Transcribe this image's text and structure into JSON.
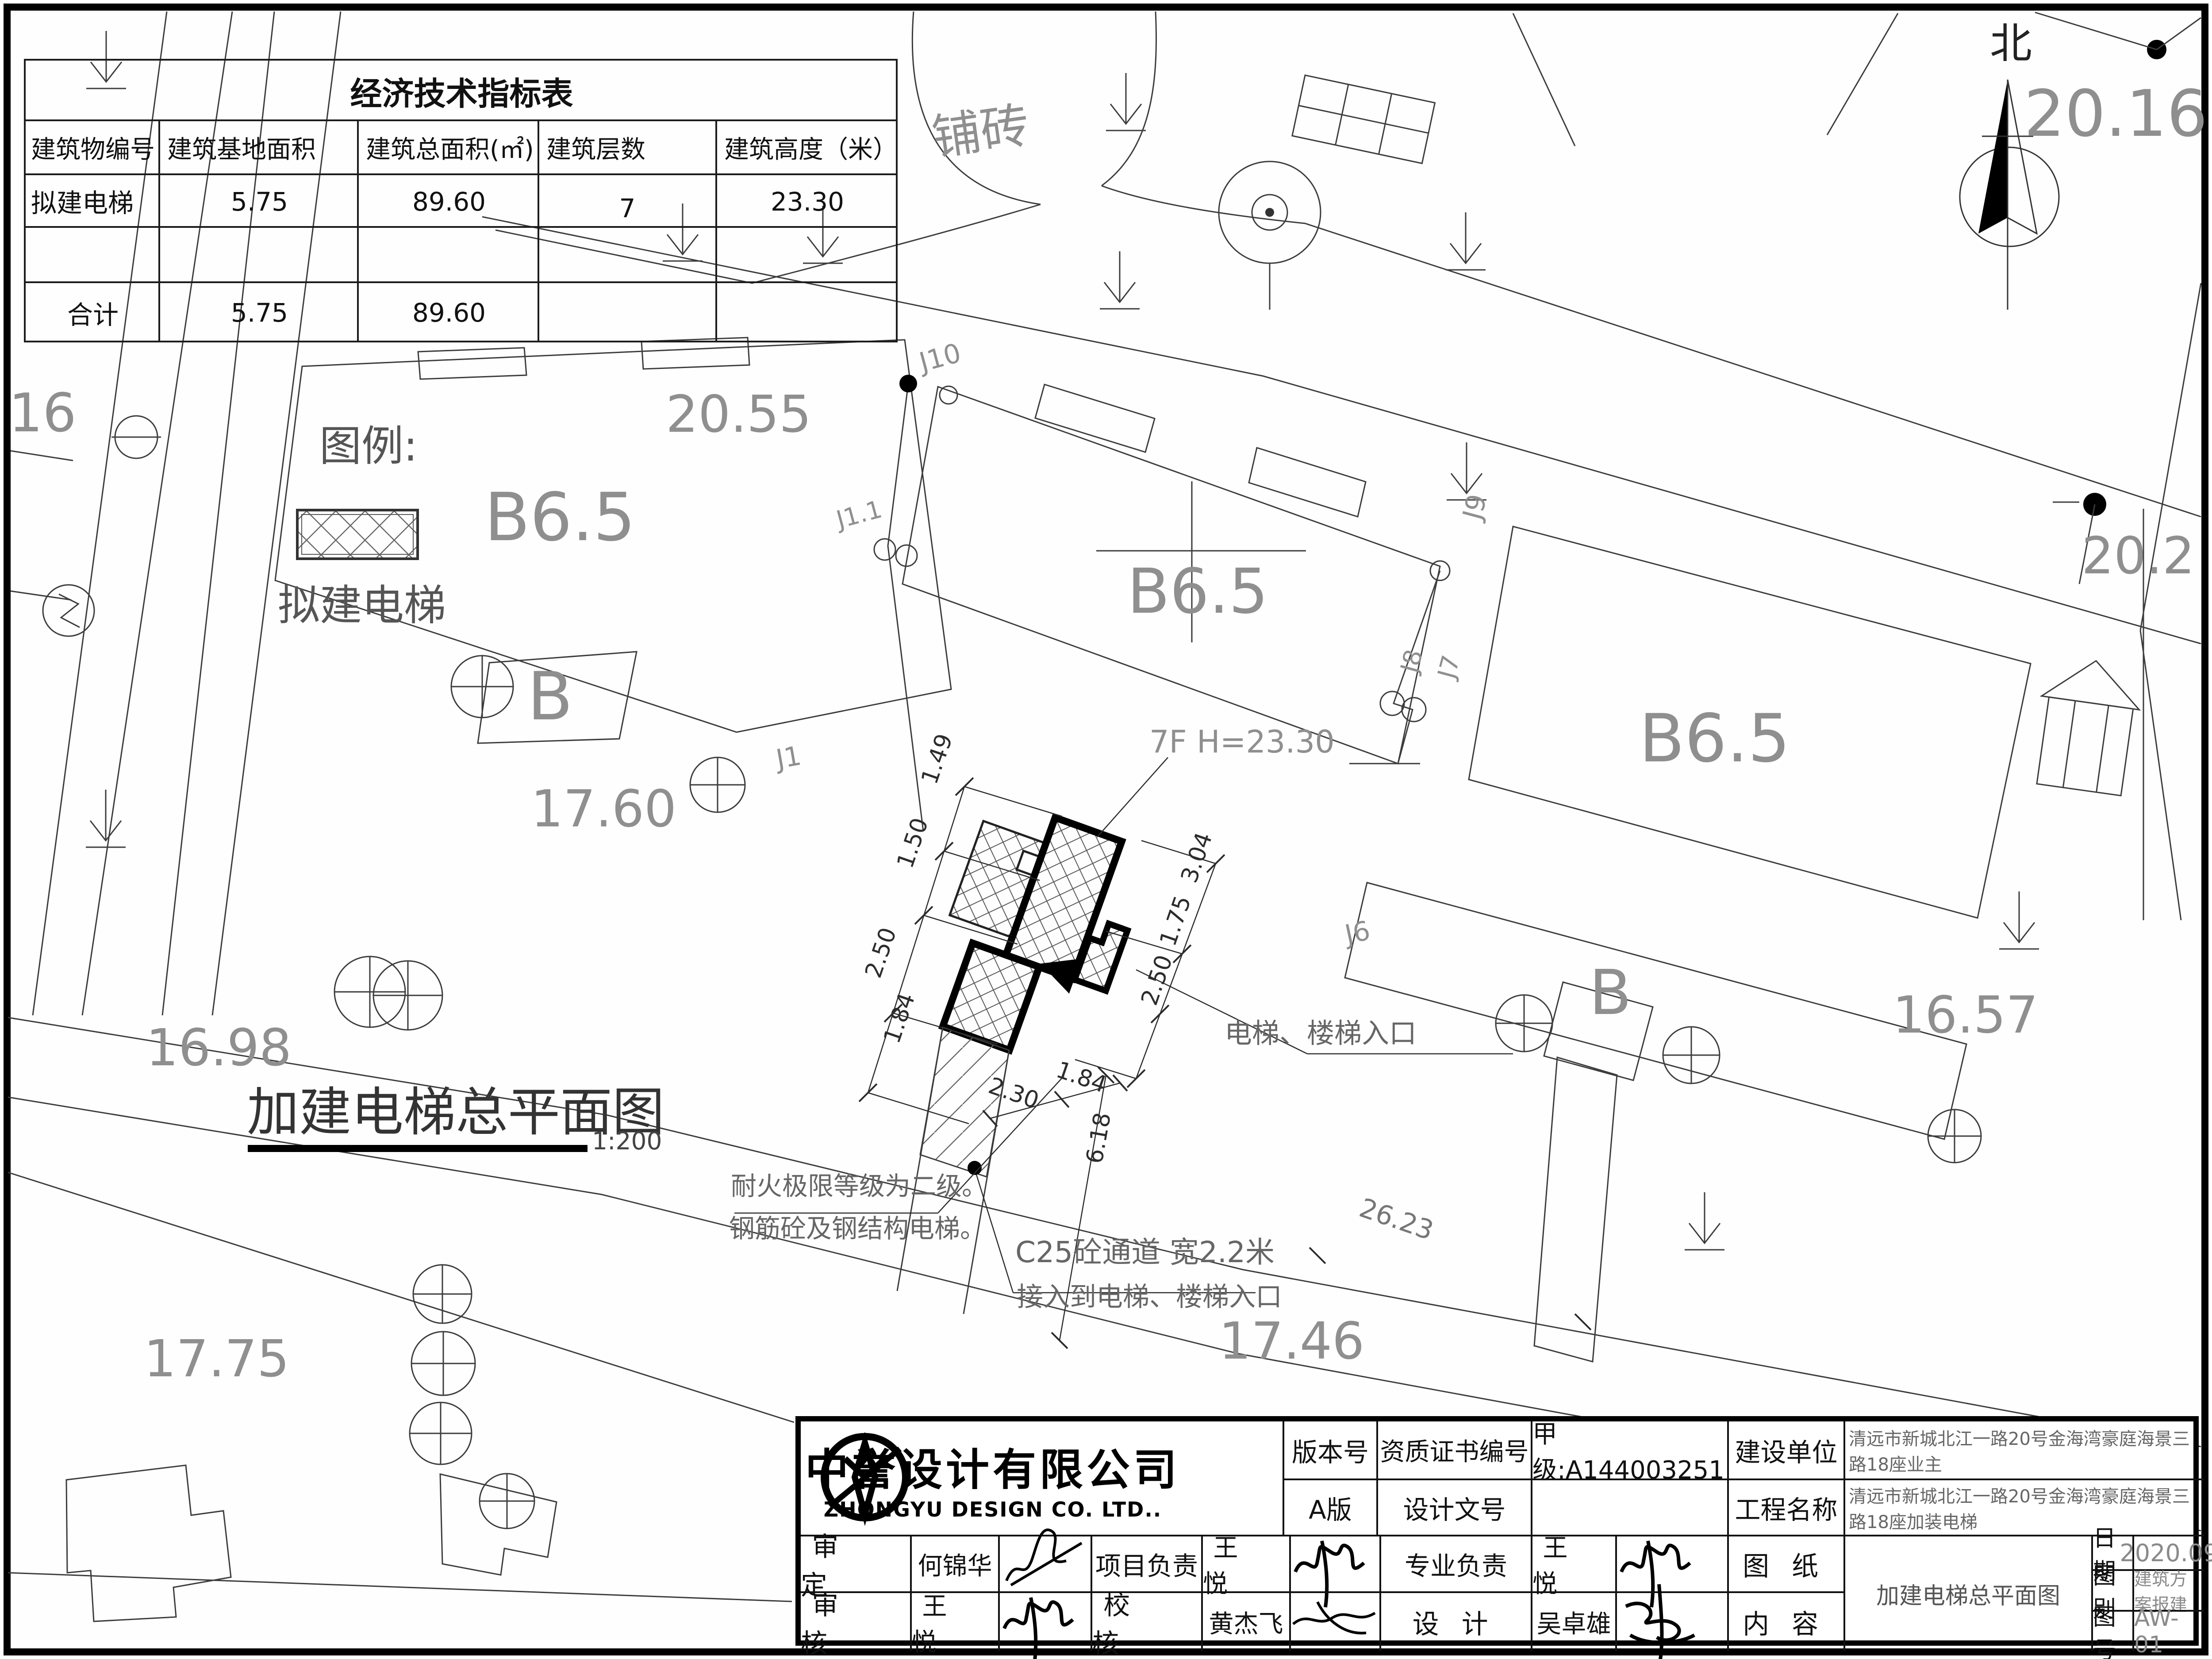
{
  "indicator_table": {
    "title": "经济技术指标表",
    "headers": [
      "建筑物编号",
      "建筑基地面积",
      "建筑总面积(㎡)",
      "建筑层数",
      "建筑高度（米）"
    ],
    "rows": [
      [
        "拟建电梯",
        "5.75",
        "89.60",
        "7",
        "23.30"
      ],
      [
        "",
        "",
        "",
        "",
        ""
      ],
      [
        "合计",
        "5.75",
        "89.60",
        "",
        ""
      ]
    ]
  },
  "labels": {
    "north": "北",
    "legend_title": "图例:",
    "legend_item": "拟建电梯",
    "paving": "铺砖",
    "drawing_title": "加建电梯总平面图",
    "scale": "1:200",
    "height_note": "7F H=23.30",
    "entrance_note": "电梯、楼梯入口",
    "fire_note_1": "耐火极限等级为二级。",
    "fire_note_2": "钢筋砼及钢结构电梯。",
    "passage_note_1": "C25砼通道 宽2.2米",
    "passage_note_2": "接入到电梯、楼梯入口",
    "e16": "16",
    "e2016": "20.16",
    "e2055": "20.55",
    "e1760": "17.60",
    "e1698": "16.98",
    "e1775": "17.75",
    "e1746": "17.46",
    "e1657": "16.57",
    "e202": "20.2",
    "b65_left": "B6.5",
    "b65_mid": "B6.5",
    "b65_right": "B6.5",
    "b_left": "B",
    "b_right": "B",
    "j10": "J10",
    "j11": "J1.1",
    "j1": "J1",
    "j9": "J9",
    "j8": "J8",
    "j7": "J7",
    "j6": "J6",
    "d149": "1.49",
    "d150": "1.50",
    "d250a": "2.50",
    "d184a": "1.84",
    "d230": "2.30",
    "d184b": "1.84",
    "d304": "3.04",
    "d175": "1.75",
    "d250b": "2.50",
    "d618": "6.18",
    "d2623": "26.23"
  },
  "titleblock": {
    "company_cn": "中誉设计有限公司",
    "company_en": "ZHONGYU DESIGN CO. LTD..",
    "version_label": "版本号",
    "version_value": "A版",
    "cert_label": "资质证书编号",
    "cert_value": "甲级:A144003251",
    "doc_label": "设计文号",
    "doc_value": "",
    "owner_label": "建设单位",
    "owner_value": "清远市新城北江一路20号金海湾豪庭海景三路18座业主",
    "project_label": "工程名称",
    "project_value": "清远市新城北江一路20号金海湾豪庭海景三路18座加装电梯",
    "approve_label": "审定",
    "approve_name": "何锦华",
    "pm_label": "项目负责",
    "pm_name": "王悦",
    "lead_label": "专业负责",
    "lead_name": "王悦",
    "review_label": "审核",
    "review_name": "王悦",
    "check_label": "校核",
    "check_name": "黄杰飞",
    "design_label": "设计",
    "designer_name": "吴卓雄",
    "sheet_label": "图纸",
    "content_label": "内容",
    "content_value": "加建电梯总平面图",
    "date_label": "日期",
    "date_value": "2020.09",
    "category_label": "图别",
    "category_value": "建筑方案报建",
    "number_label": "图号",
    "number_value": "AW-01"
  }
}
